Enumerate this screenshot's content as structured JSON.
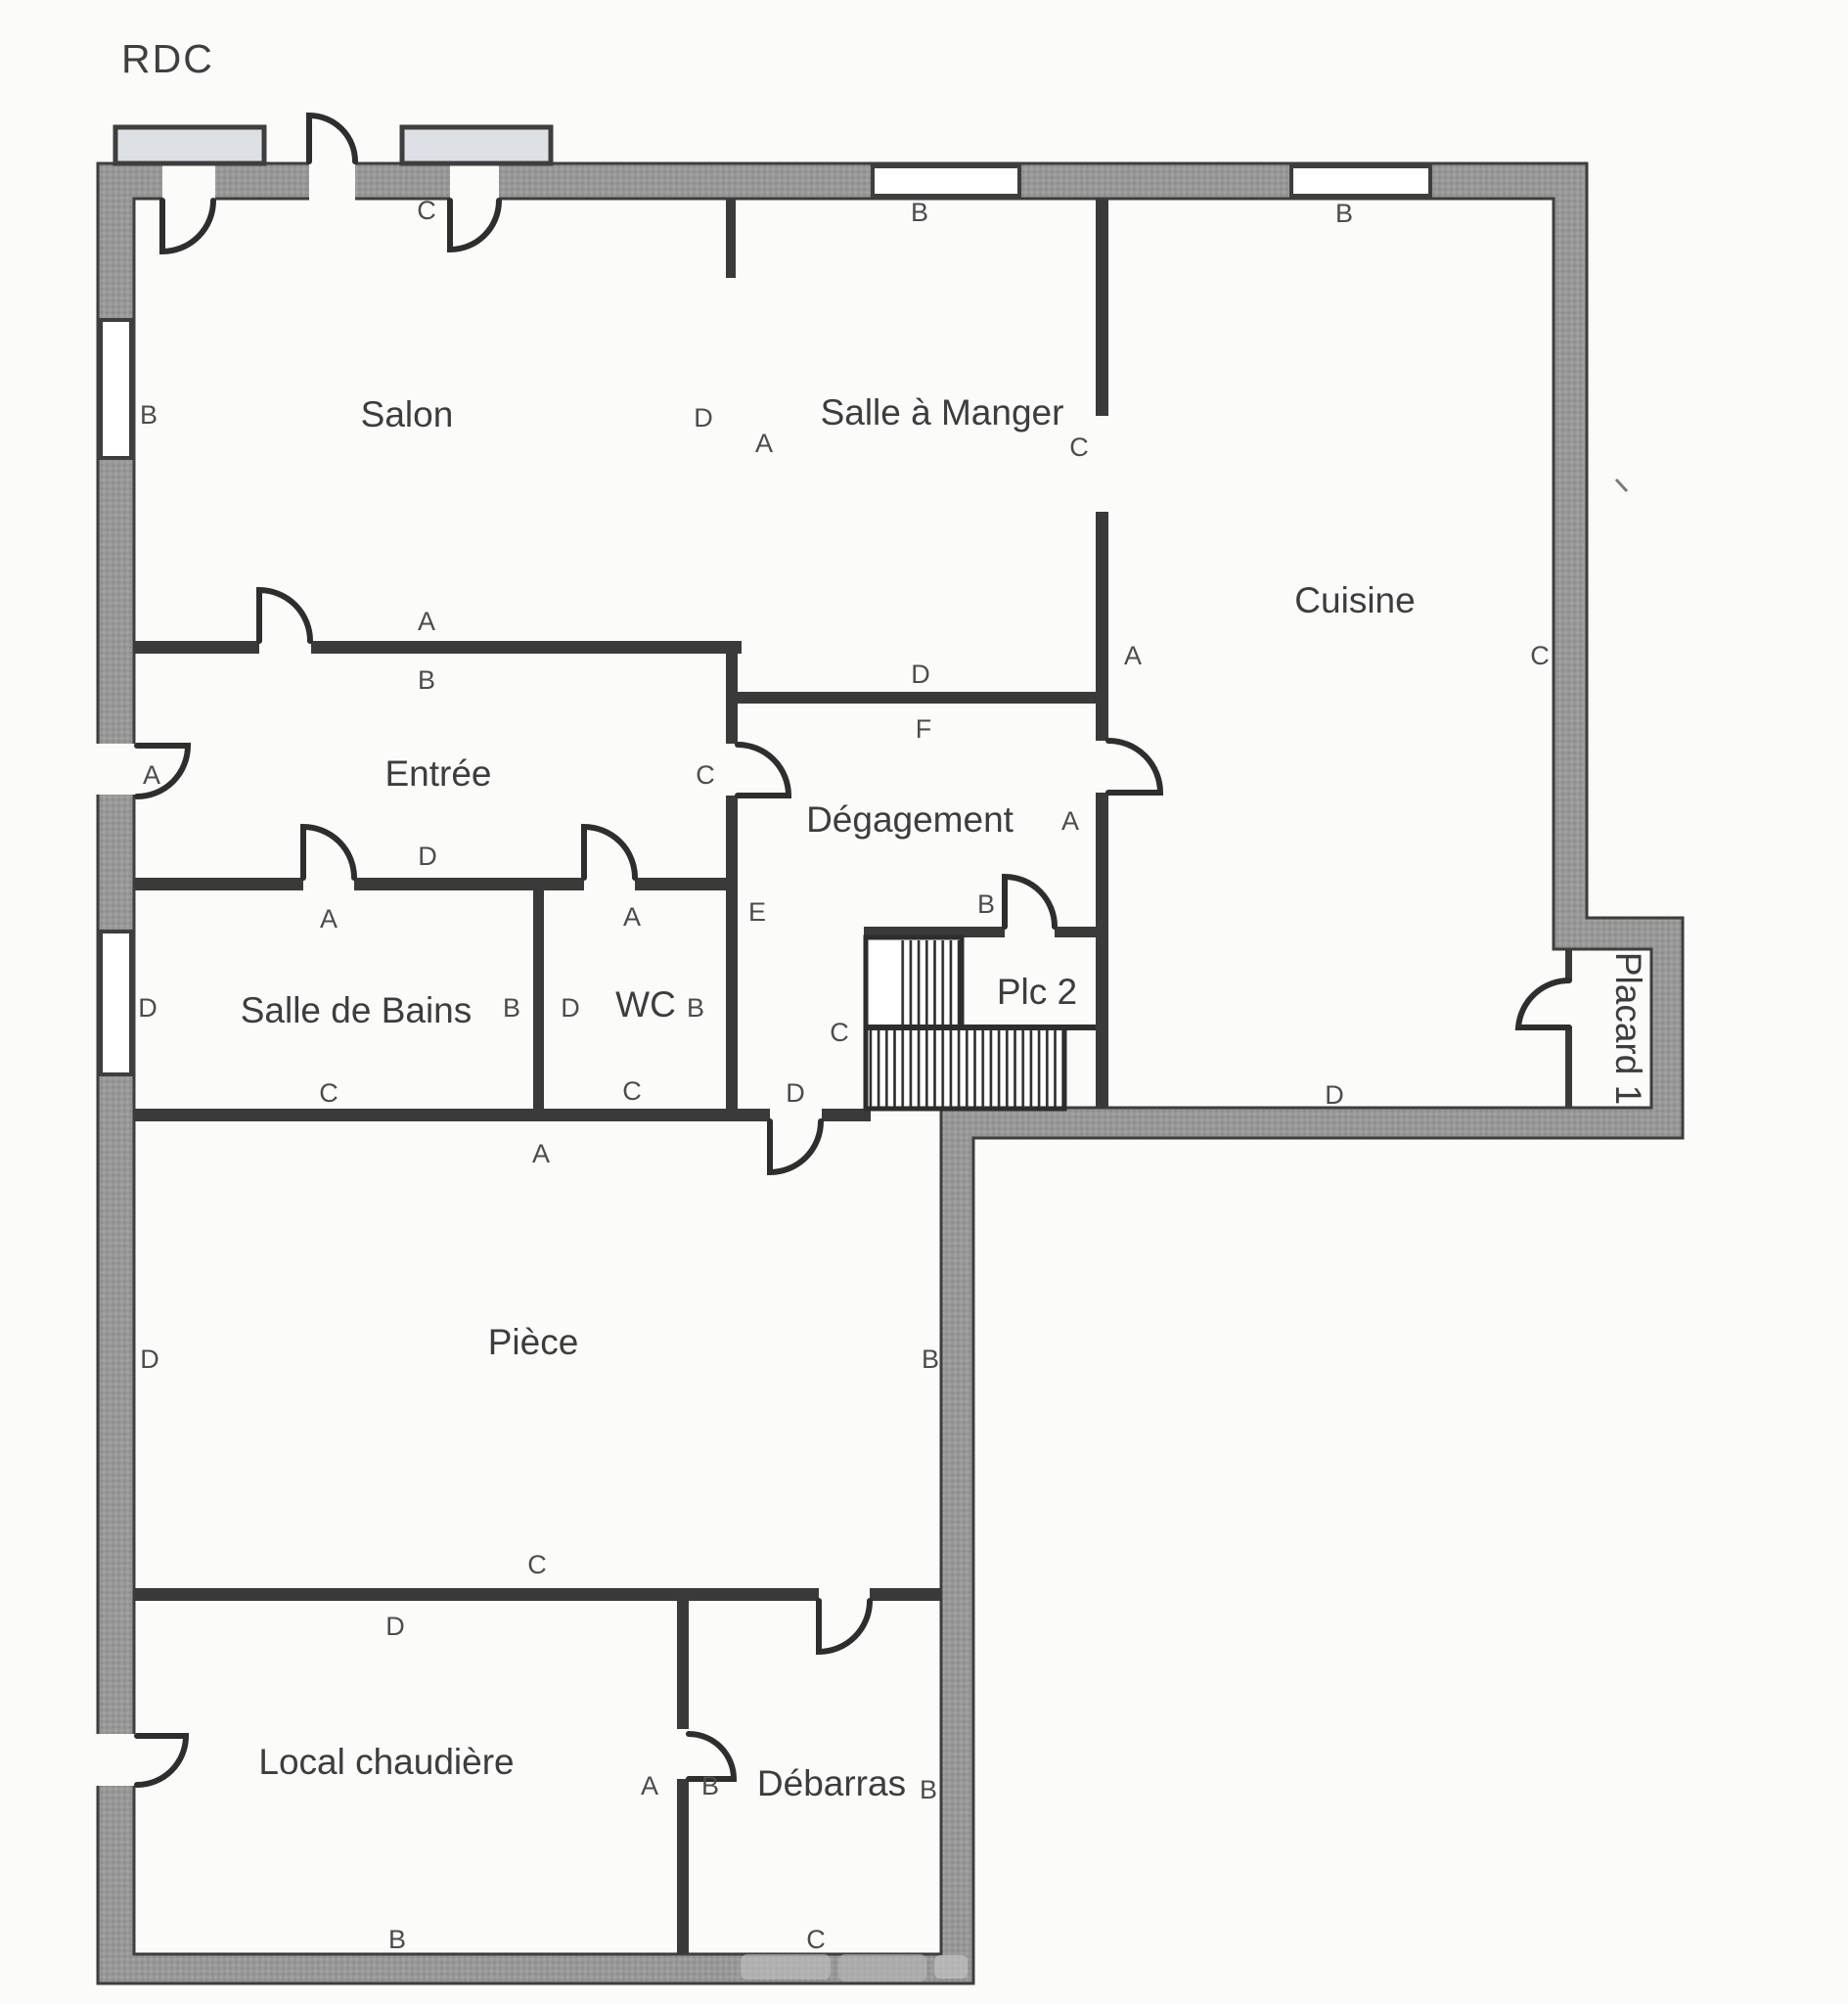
{
  "title": "RDC",
  "rooms": {
    "salon": "Salon",
    "salle_a_manger": "Salle à Manger",
    "cuisine": "Cuisine",
    "entree": "Entrée",
    "degagement": "Dégagement",
    "salle_de_bains": "Salle de Bains",
    "wc": "WC",
    "plc2": "Plc 2",
    "placard1": "Placard 1",
    "piece": "Pièce",
    "local_chaudiere": "Local chaudière",
    "debarras": "Débarras"
  },
  "letters": [
    "C",
    "B",
    "B",
    "B",
    "D",
    "A",
    "C",
    "A",
    "B",
    "A",
    "C",
    "D",
    "F",
    "A",
    "C",
    "D",
    "A",
    "E",
    "B",
    "A",
    "A",
    "D",
    "B",
    "D",
    "B",
    "C",
    "C",
    "C",
    "D",
    "D",
    "A",
    "D",
    "B",
    "C",
    "D",
    "A",
    "B",
    "B",
    "B",
    "C"
  ],
  "colors": {
    "exterior_wall": "#979797",
    "wall_edge": "#3e3e3e",
    "interior_wall": "#3a3a3a",
    "door_line": "#2e2e2e",
    "shutter_fill": "#dde1e6",
    "text": "#3d3d3d",
    "paper": "#fbfbfa"
  }
}
